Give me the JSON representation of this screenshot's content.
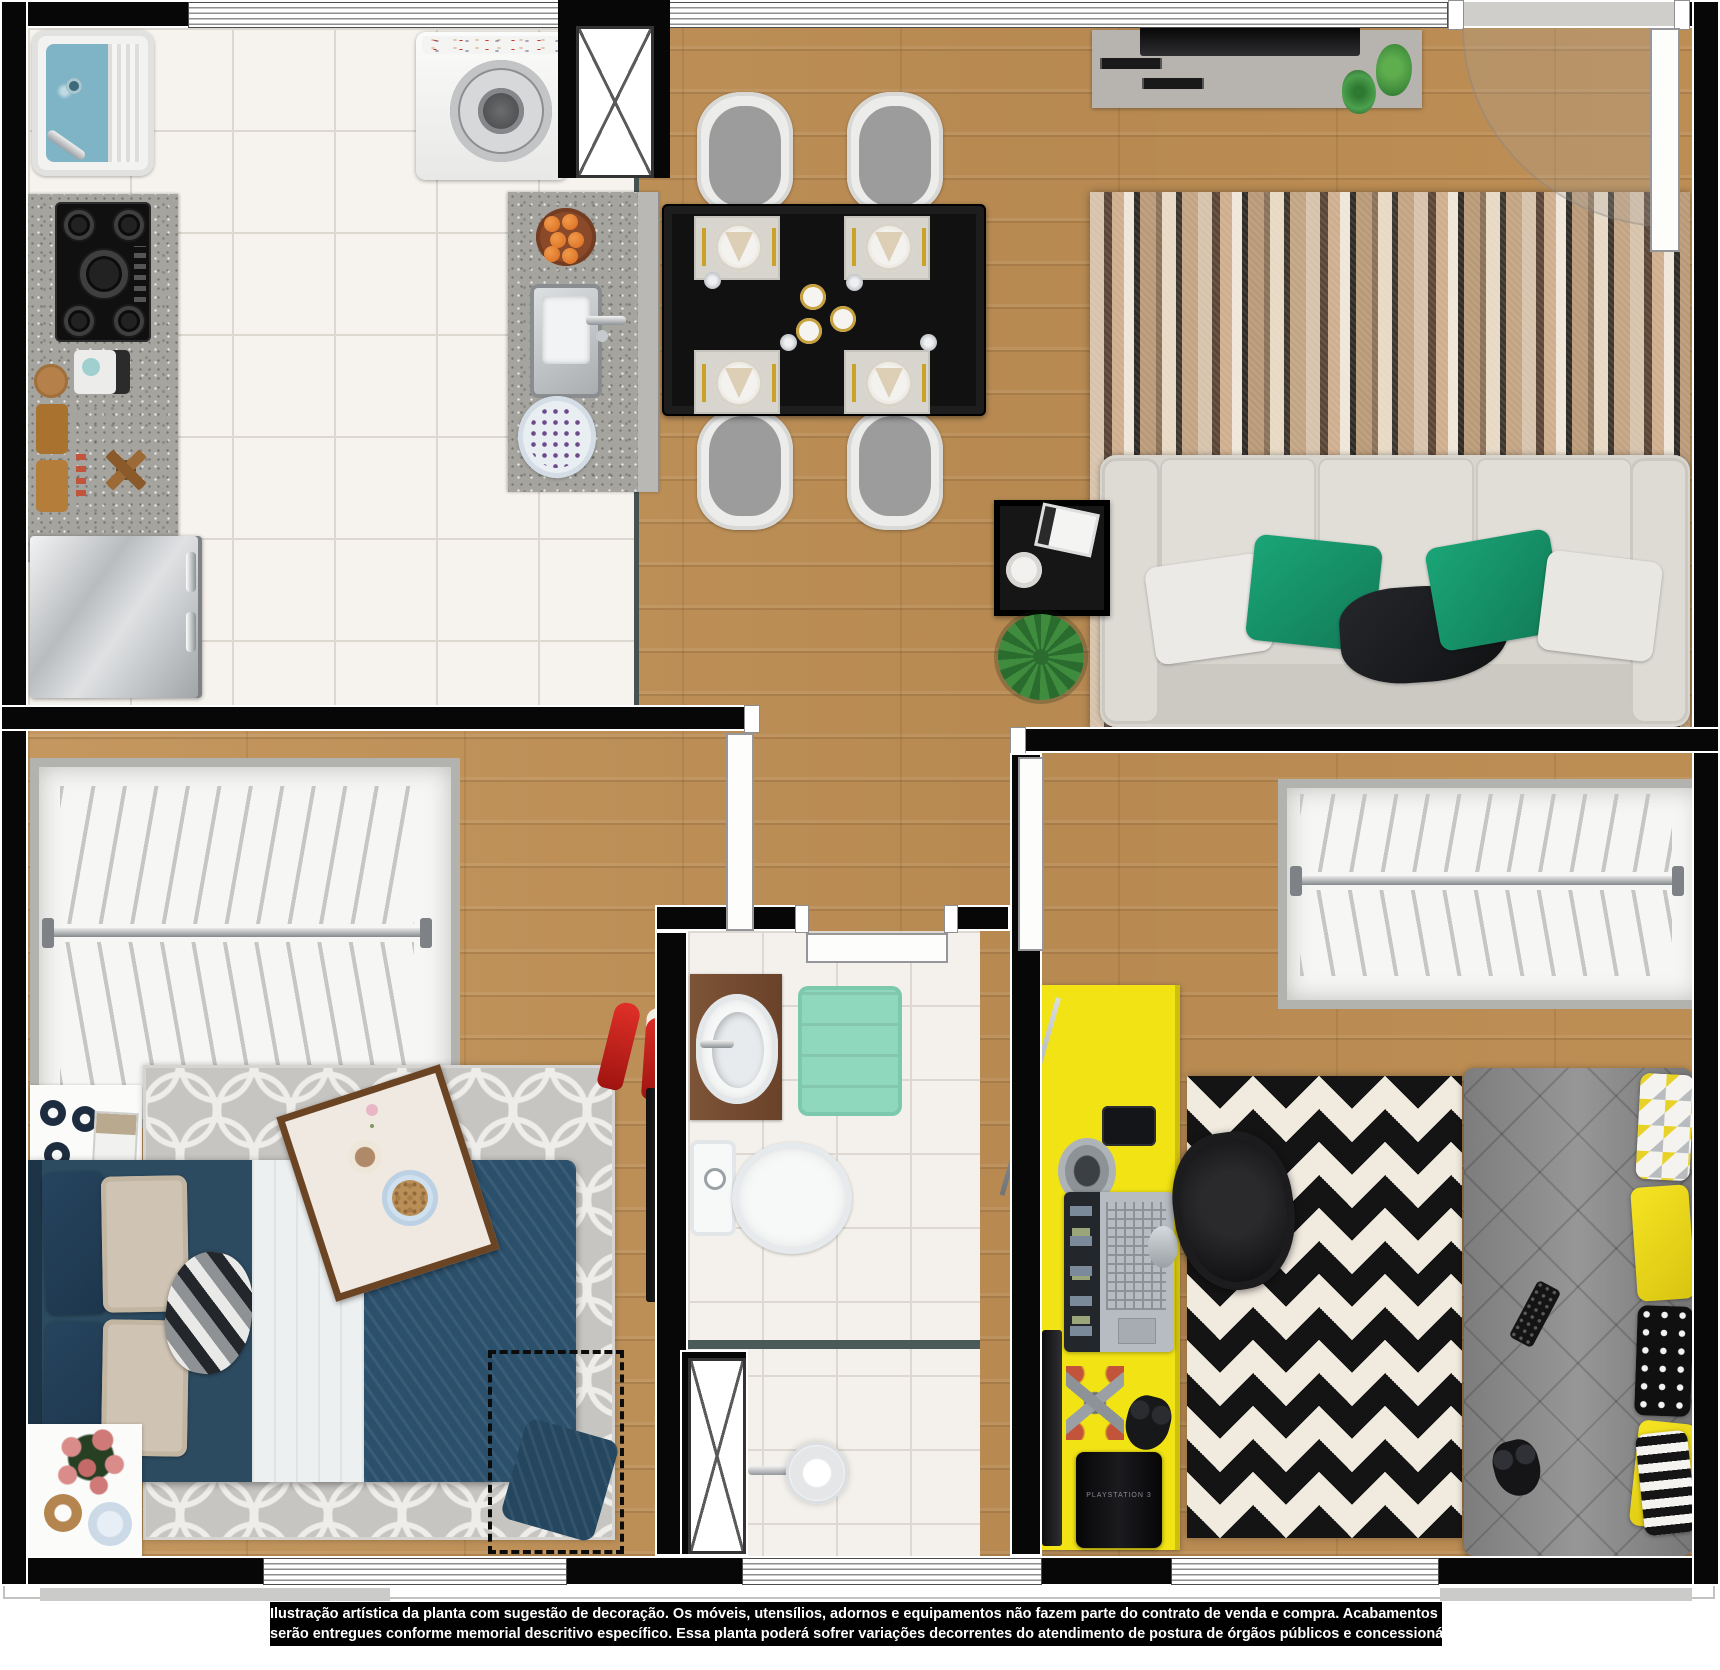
{
  "disclaimer": {
    "line1": "Ilustração artística da planta com sugestão de decoração. Os móveis, utensílios, adornos e equipamentos não fazem parte do contrato de venda e compra. Acabamentos e revestimentos",
    "line2": "serão entregues conforme memorial descritivo específico. Essa planta poderá sofrer variações decorrentes do atendimento de postura de órgãos públicos e concessionárias."
  },
  "labels": {
    "game_console": "PLAYSTATION 3"
  },
  "palette": {
    "wall": "#070707",
    "wood_floor": "#c19156",
    "kitchen_tile": "#f6f3ee",
    "bath_tile": "#f4f1ec",
    "granite_counter": "#a5a49e",
    "navy_bed": "#2c4a60",
    "mint_bathmat": "#8fd7bd",
    "yellow_desk": "#f2e414",
    "sofa_gray": "#d8d5cf",
    "pillow_green": "#17996e",
    "bed2_gray": "#8e8e8e",
    "trellis_rug": "#c7c5c2",
    "chevron_dark": "#141414",
    "chevron_light": "#f0eadf",
    "glass_partition": "#4a5a58"
  }
}
